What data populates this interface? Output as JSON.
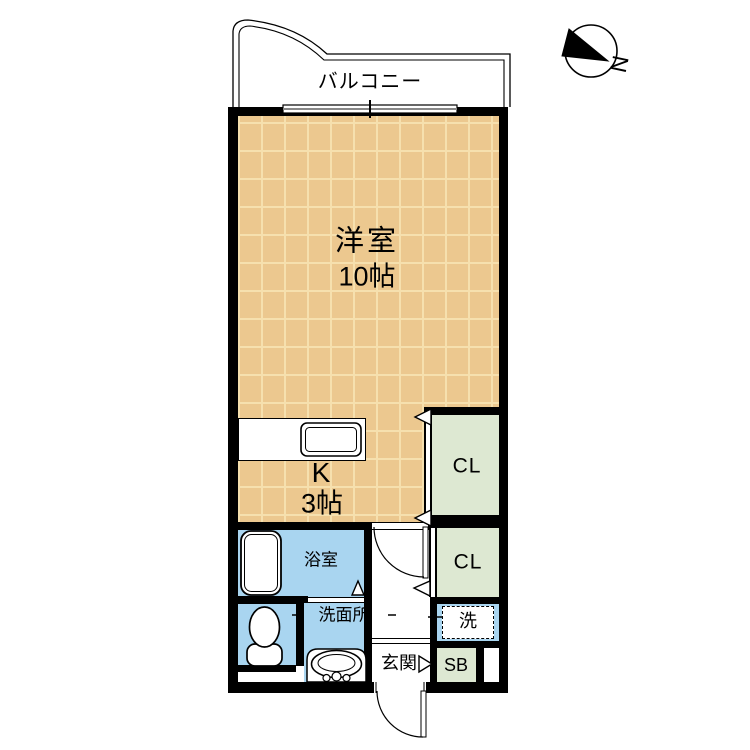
{
  "compass": {
    "label": "N"
  },
  "balcony": {
    "label": "バルコニー"
  },
  "rooms": {
    "living": {
      "label": "洋室",
      "size": "10帖"
    },
    "kitchen": {
      "label": "K",
      "size": "3帖"
    },
    "closet_upper": {
      "label": "CL"
    },
    "closet_lower": {
      "label": "CL"
    },
    "bath": {
      "label": "浴室"
    },
    "washroom": {
      "label": "洗面所"
    },
    "entrance": {
      "label": "玄関"
    },
    "laundry": {
      "label": "洗"
    },
    "shoe_box": {
      "label": "SB"
    }
  },
  "colors": {
    "floor": "#ECC88F",
    "floor_line": "#F6E0AE",
    "closet": "#DDE8D2",
    "wet_area": "#A9D5F0",
    "wall": "#000000"
  }
}
